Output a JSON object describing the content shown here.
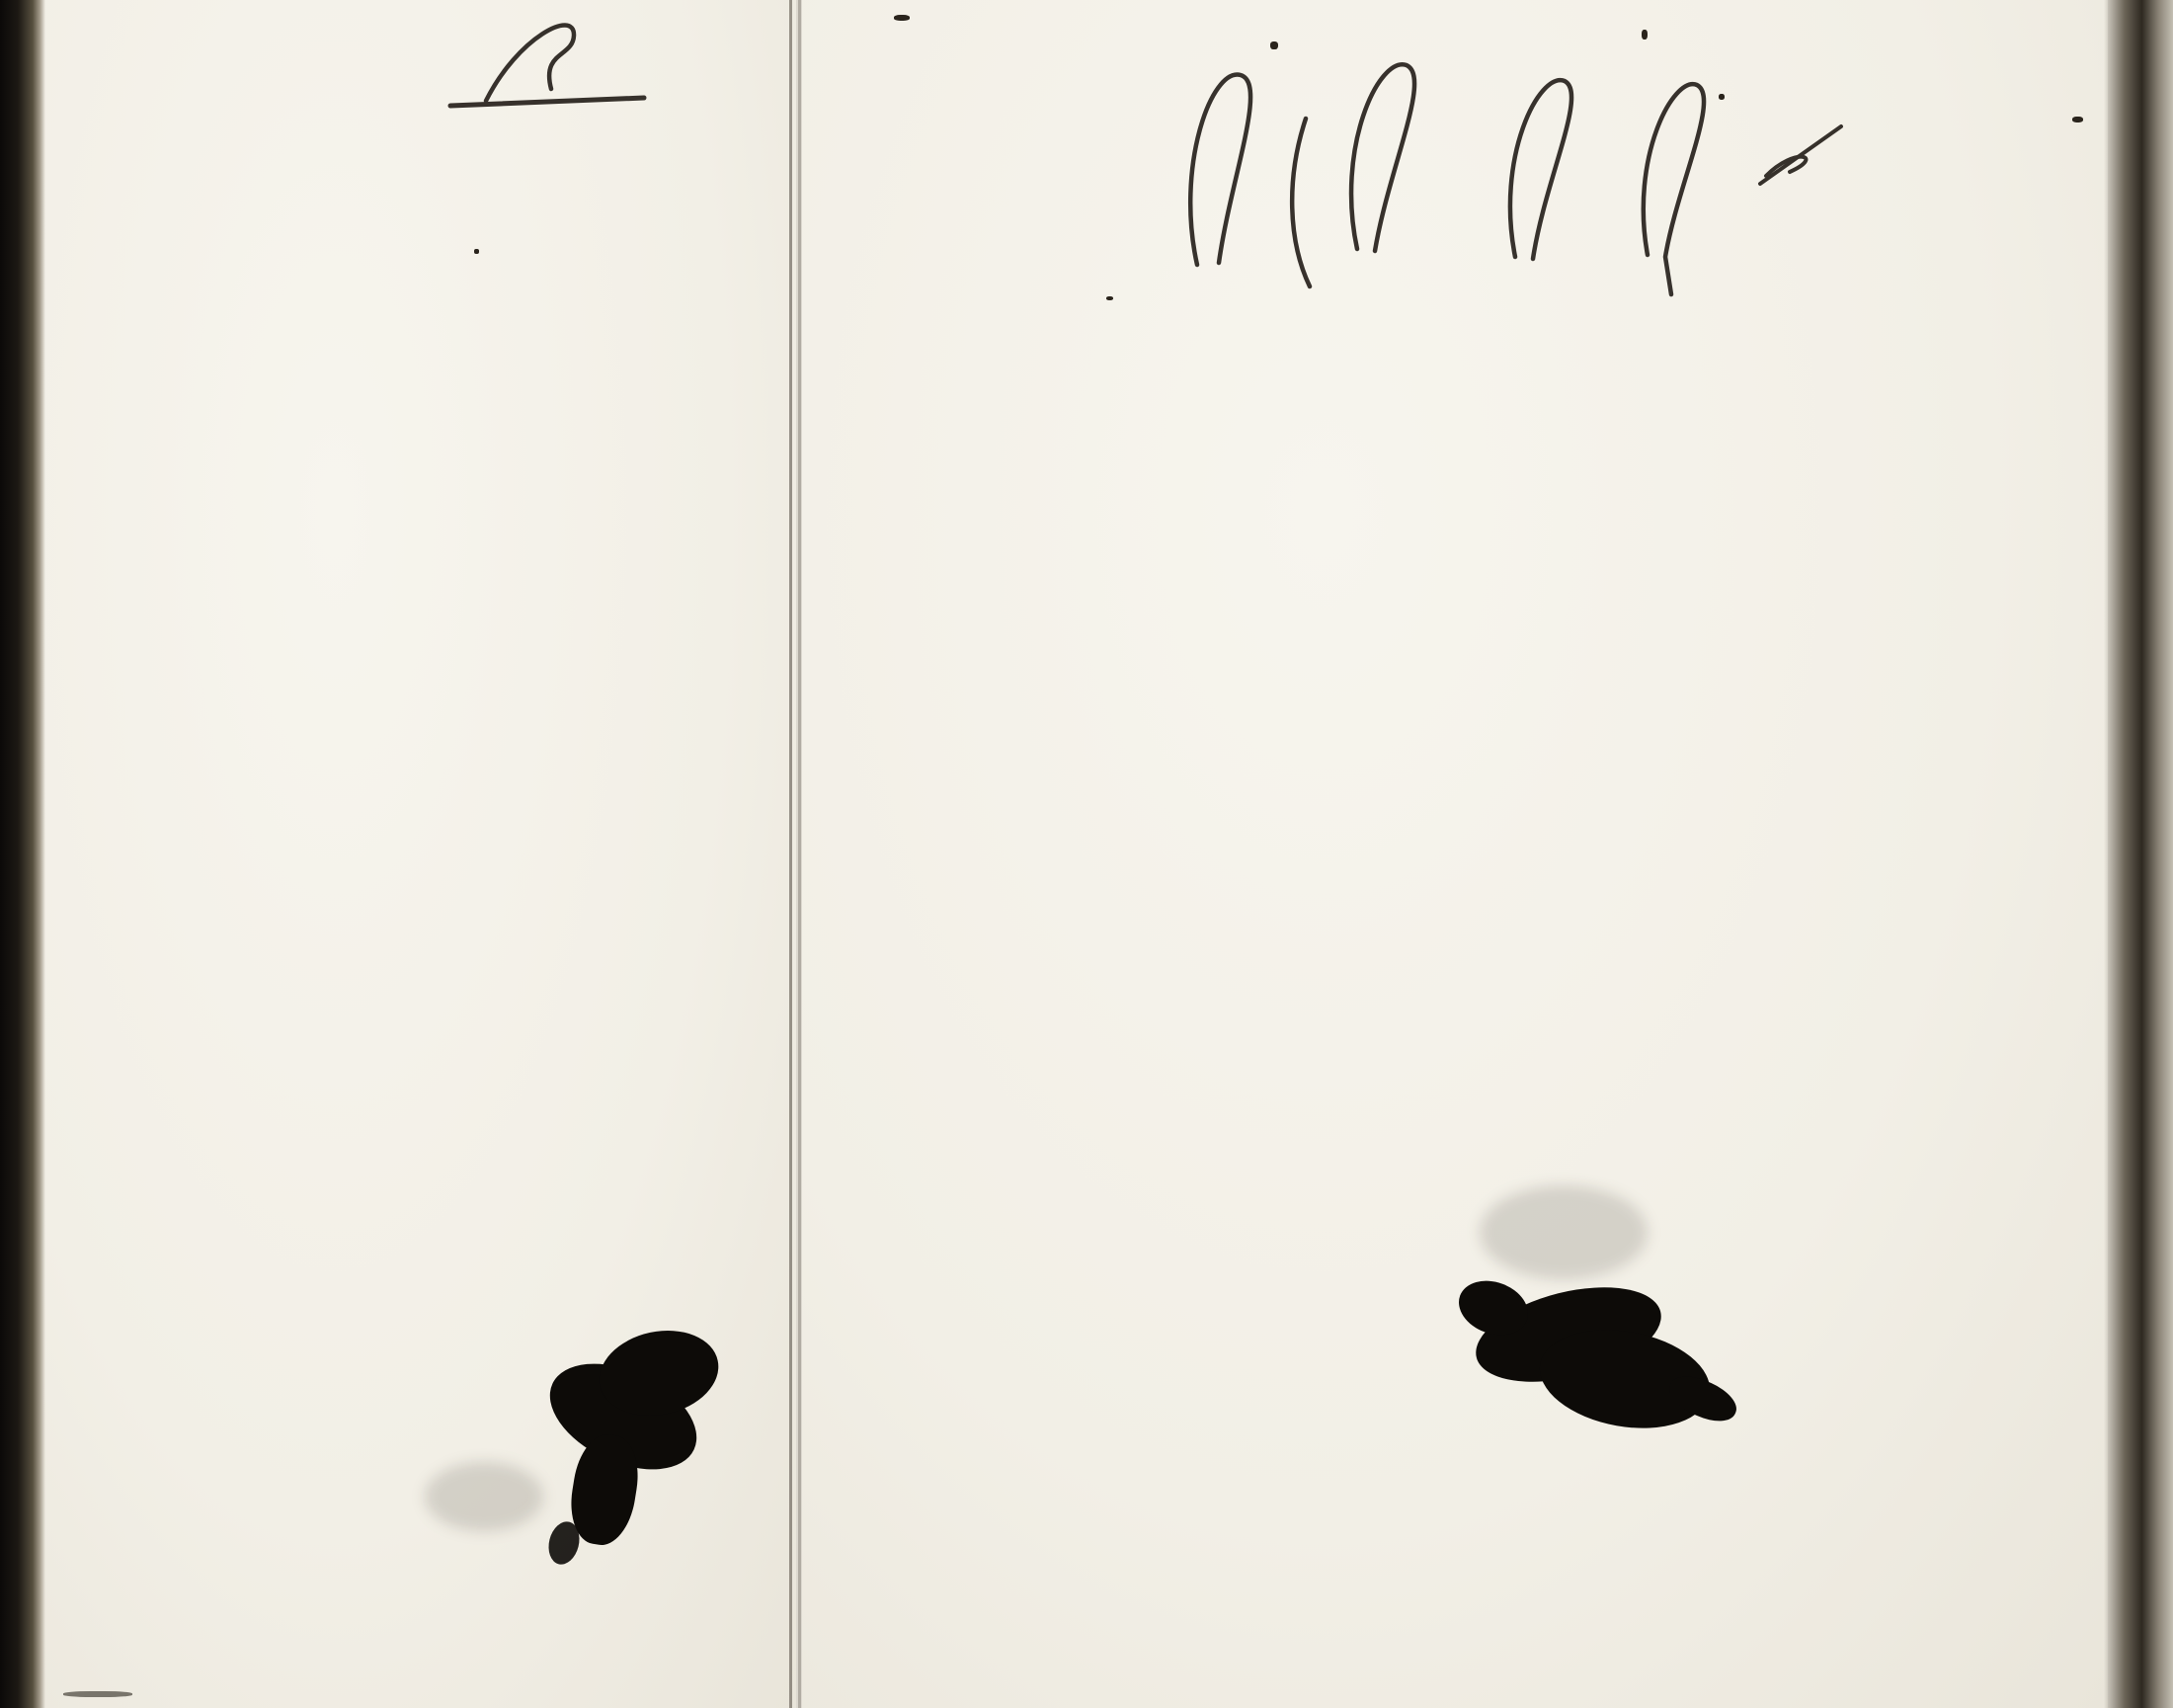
{
  "page_label": "Pag: 193.",
  "left_page": {
    "corner_note": "Gualisto\nKero.",
    "header_groups": [
      {
        "label": "Dec.",
        "subs": [
          "Explic.\nSimpl."
        ]
      },
      {
        "label": "Symb.",
        "subs": [
          "Explic.\nSimpl.",
          "Åtman.\nExplic.\nSimpl."
        ]
      },
      {
        "label": "Or.I.",
        "subs": [
          "Explic.\nSimpl."
        ]
      },
      {
        "label": "Bapt.",
        "subs": [
          "Explic.\nSimpl."
        ]
      },
      {
        "label": "Abſ.",
        "subs": [
          "Explic.\nSimpl."
        ]
      },
      {
        "label": "Conf.",
        "subs": [
          "1.\n2.\n3."
        ]
      },
      {
        "label": "C.D.M:ns.",
        "subs": [
          "Explic.\nSimpl.",
          "Grat. a.\nBened."
        ]
      },
      {
        "label": "Orat.",
        "subs": [
          "Vesper.\nMatut."
        ]
      },
      {
        "label": "Quæst.",
        "subs": [
          "Dict.S.S.\nPlenius.\nAliq. m."
        ]
      },
      {
        "label": "Tæc.",
        "subs": [
          "Plenius.\nAliq. m."
        ]
      },
      {
        "label": "L.m.",
        "subs": [
          "Exact.\nAliq. m."
        ]
      }
    ],
    "rows": [
      {
        "band": 0,
        "margin": "",
        "name": "Unga Bonden Johan Jacobsson",
        "cells": [
          "",
          "3",
          "2",
          "2",
          "2",
          "2",
          "3",
          "2",
          "2",
          "2",
          "6.Ɔ.7",
          "2",
          "XX"
        ]
      },
      {
        "band": 1,
        "margin": "",
        "name": "H. Maria Stina Johansd:r",
        "cells": [
          "X2",
          "3",
          "2",
          "2",
          "1",
          "3",
          "2",
          "2",
          "2",
          "2",
          "6 G.\n9:7",
          "2",
          "+X"
        ]
      },
      {
        "band": 2,
        "margin": "",
        "name": "Gamla Bonden Jacob Jacobsson",
        "cells": [
          "",
          "",
          "",
          "",
          "",
          "",
          "Patich",
          "",
          "",
          "",
          "",
          "2",
          "XX."
        ]
      },
      {
        "band": 3,
        "margin": "",
        "name": "H: Lisa Jacobsd:r",
        "cells": [
          "",
          "",
          "",
          "",
          "",
          "",
          "D:o",
          "",
          "",
          "",
          "",
          "2",
          "XX"
        ]
      },
      {
        "band": 4,
        "margin": "",
        "name": "Son Jacob",
        "cells": [
          "2",
          "3",
          "2",
          "2",
          "2",
          "3",
          "2",
          "2",
          "2",
          "2",
          "X+4\nXX",
          "2",
          "XY"
        ]
      },
      {
        "band": 5,
        "margin": "ab",
        "name": "Pigan Majastina Gabriels d:r",
        "cells": [
          "",
          "",
          "",
          "",
          "",
          "",
          "Path:",
          "",
          "",
          "",
          "X++",
          "",
          "XY."
        ]
      },
      {
        "band": 6,
        "margin": "ab",
        "name": "Pigan Hedvig Alexandersd:r",
        "cells": [
          "",
          "3",
          "2",
          "2",
          "2",
          "3",
          "",
          "2",
          "2",
          "2",
          "6.Ɔ.7.",
          "1",
          "+X"
        ]
      },
      {
        "band": 7,
        "margin": "ab",
        "name": "Drengen Matts Johansson",
        "cells": [
          "2",
          "3",
          "2",
          "2",
          "2",
          "3",
          "",
          "",
          "",
          "",
          "6.Ɔ.7.",
          "1",
          "+X"
        ]
      },
      {
        "band": 8,
        "margin": "ab:",
        "name": "H: Caisa Johansd:r",
        "cells": [
          "2",
          "3",
          "2",
          "2",
          "2",
          "3",
          "",
          "",
          "",
          "",
          "6.Ɔ.7.",
          "—",
          "+X"
        ]
      },
      {
        "band": 9,
        "margin": "ab",
        "name": "Son Carl Gustaf",
        "cells": [
          "",
          "",
          "",
          "",
          "",
          "",
          "",
          "",
          "",
          "",
          "",
          "",
          ""
        ]
      },
      {
        "band": 10,
        "margin": "ab",
        "name": "Torp Johan Jacobsson",
        "cells": [
          "2",
          "3",
          "2",
          "2",
          "2",
          "3",
          "2",
          "2",
          "2",
          "2",
          "XX'.",
          "2",
          "+X"
        ]
      },
      {
        "band": 11,
        "margin": "ab",
        "name": "Pig Maria Stina Thomasd:r",
        "struck_word": "Stina",
        "cells": [
          "2",
          "3",
          "2",
          "2",
          "2",
          "3",
          "",
          "",
          "",
          "",
          "64:",
          "",
          "+X"
        ]
      },
      {
        "band": 12,
        "margin": "ab",
        "name": "H. Johan Johansson",
        "cells": [
          "2",
          "3",
          "2",
          "2",
          "2",
          "3",
          "2",
          "2",
          "2",
          "",
          "6 G\n4:3",
          "++",
          "+X"
        ]
      },
      {
        "band": 13,
        "margin": "ab",
        "name": "Pig Ulrica Danielsd:r",
        "cells": [
          "3",
          "3",
          "2",
          "2",
          "2",
          "",
          "2",
          "",
          "",
          "",
          "8 G8\n9 3",
          "+X",
          "+X"
        ]
      },
      {
        "band": 14,
        "margin": "",
        "name": "Torp Matts Mattsson",
        "cells": [
          "2",
          "3",
          "2",
          "",
          "2",
          "",
          "2",
          "2",
          "2",
          "2",
          "6.",
          "XX",
          "XY"
        ]
      },
      {
        "band": 15,
        "margin": "",
        "name": "Wallborg Johansd:r",
        "cells": [
          "",
          "",
          "",
          "",
          "40 L Hjudttig.",
          "",
          "",
          "",
          "",
          "",
          "",
          "",
          ""
        ]
      }
    ]
  },
  "right_page": {
    "headers": {
      "natus": "Natus.",
      "obiit": "Obiit.",
      "d1": "D.",
      "anno1": "Anno",
      "d2": "D.",
      "anno2": "Anno.",
      "years": [
        "1796",
        "1797",
        "1798",
        "1799",
        "1800",
        "1801",
        "mens."
      ]
    },
    "rows": [
      {
        "band": 0,
        "natus_d": "28/4",
        "natus_anno": "1777",
        "marks": [
          {
            "g": 0,
            "s": 0,
            "t": "19/4"
          },
          {
            "g": 1,
            "s": 1,
            "t": "30/8"
          },
          {
            "g": 2,
            "s": 0,
            "t": "6/5"
          },
          {
            "g": 2,
            "s": 2,
            "t": "14/12"
          },
          {
            "g": 3,
            "s": 0,
            "t": "13/2"
          },
          {
            "g": 3,
            "s": 2,
            "t": "15/12"
          },
          {
            "g": 4,
            "s": 1,
            "t": "3/8"
          },
          {
            "g": 5,
            "s": 0,
            "t": "28/6"
          }
        ]
      },
      {
        "band": 1,
        "natus_d": "27/2",
        "natus_anno": "1780.",
        "marks": [
          {
            "g": 3,
            "s": 2,
            "t": "d:o"
          },
          {
            "g": 4,
            "s": 1,
            "t": "d:o"
          },
          {
            "g": 5,
            "s": 0,
            "t": "d:o"
          }
        ]
      },
      {
        "band": 2,
        "natus_d": "30/4",
        "natus_anno": "1735",
        "marks": [
          {
            "g": 0,
            "s": 0,
            "t": "d:o"
          },
          {
            "g": 1,
            "s": 1,
            "t": "13/12"
          },
          {
            "g": 3,
            "s": 0,
            "t": "—"
          },
          {
            "g": 4,
            "s": 1,
            "t": "—"
          },
          {
            "g": 5,
            "s": 1,
            "t": "25/3"
          },
          {
            "g": 6,
            "s": 1,
            "t": "—"
          }
        ]
      },
      {
        "band": 3,
        "natus_d": "20/9",
        "natus_anno": "1741",
        "marks": [
          {
            "g": 0,
            "s": 0,
            "t": "d:o"
          },
          {
            "g": 0,
            "s": 2,
            "t": "25/5"
          },
          {
            "g": 1,
            "s": 0,
            "t": "d:o"
          },
          {
            "g": 3,
            "s": 0,
            "t": "6/10"
          },
          {
            "g": 3,
            "s": 2,
            "t": "22/9"
          },
          {
            "g": 4,
            "s": 1,
            "t": "—"
          },
          {
            "g": 5,
            "s": 1,
            "t": "—"
          }
        ]
      },
      {
        "band": 4,
        "natus_d": "27/3",
        "natus_anno": "1732",
        "marks": [
          {
            "g": 1,
            "s": 1,
            "t": "d:o"
          },
          {
            "g": 1,
            "s": 2,
            "t": "12/8"
          },
          {
            "g": 3,
            "s": 0,
            "t": "1/1"
          },
          {
            "g": 3,
            "s": 1,
            "t": "9/5"
          },
          {
            "g": 3,
            "s": 2,
            "t": "15/12"
          },
          {
            "g": 4,
            "s": 1,
            "t": "3/8"
          },
          {
            "g": 5,
            "s": 1,
            "t": "17/3"
          }
        ]
      },
      {
        "band": 5,
        "natus_d": "",
        "natus_anno": "1780",
        "marks": []
      },
      {
        "band": 6,
        "natus_d": "14/1",
        "natus_anno": "1775",
        "marks": [
          {
            "g": 0,
            "s": 0,
            "t": "2/10"
          },
          {
            "g": 0,
            "s": 2,
            "t": "25/3"
          },
          {
            "g": 1,
            "s": 0,
            "t": "15/10"
          }
        ]
      },
      {
        "band": 7,
        "natus_d": "2/12",
        "natus_anno": "1776",
        "marks": [
          {
            "g": 0,
            "s": 0,
            "t": "7/7"
          }
        ]
      },
      {
        "band": 8,
        "natus_d": "5/9",
        "natus_anno": "1773",
        "marks": [
          {
            "g": 0,
            "s": 0,
            "t": "d:o"
          }
        ]
      },
      {
        "band": 9,
        "natus_d": "",
        "natus_anno": "1794",
        "marks": []
      },
      {
        "band": 10,
        "natus_d": "20/2",
        "natus_anno": "1780",
        "marks": [
          {
            "g": 1,
            "s": 1,
            "t": "3/12"
          },
          {
            "g": 1,
            "s": 2,
            "t": "13/8"
          }
        ]
      },
      {
        "band": 11,
        "natus_d": "14/3",
        "natus_anno": "1779",
        "marks": [
          {
            "g": 1,
            "s": 1,
            "t": "26/12"
          },
          {
            "g": 2,
            "s": 0,
            "t": "19/6"
          },
          {
            "g": 3,
            "s": 1,
            "t": "1/1"
          },
          {
            "g": 3,
            "s": 2,
            "t": "13/5"
          },
          {
            "g": 4,
            "s": 0,
            "t": "11/5"
          },
          {
            "g": 4,
            "s": 1,
            "t": "5/10"
          }
        ]
      },
      {
        "band": 12,
        "natus_d": "",
        "natus_anno": "1782",
        "marks": [
          {
            "g": 4,
            "s": 1,
            "t": "d:o"
          },
          {
            "g": 6,
            "s": 0,
            "t": "Nåshult\n1800 6/12",
            "note": true
          }
        ]
      },
      {
        "band": 13,
        "natus_d": "3/4",
        "natus_anno": "1784",
        "marks": [
          {
            "g": 5,
            "s": 1,
            "t": "Kulla\n1800 23/12",
            "note": true
          }
        ]
      },
      {
        "band": 14,
        "natus_d": "10/2",
        "natus_anno": "1781",
        "marks": [
          {
            "g": 5,
            "s": 2,
            "t": "15/12"
          }
        ]
      },
      {
        "band": 15,
        "natus_d": "27",
        "natus_anno": "1770.",
        "marks": []
      }
    ]
  }
}
